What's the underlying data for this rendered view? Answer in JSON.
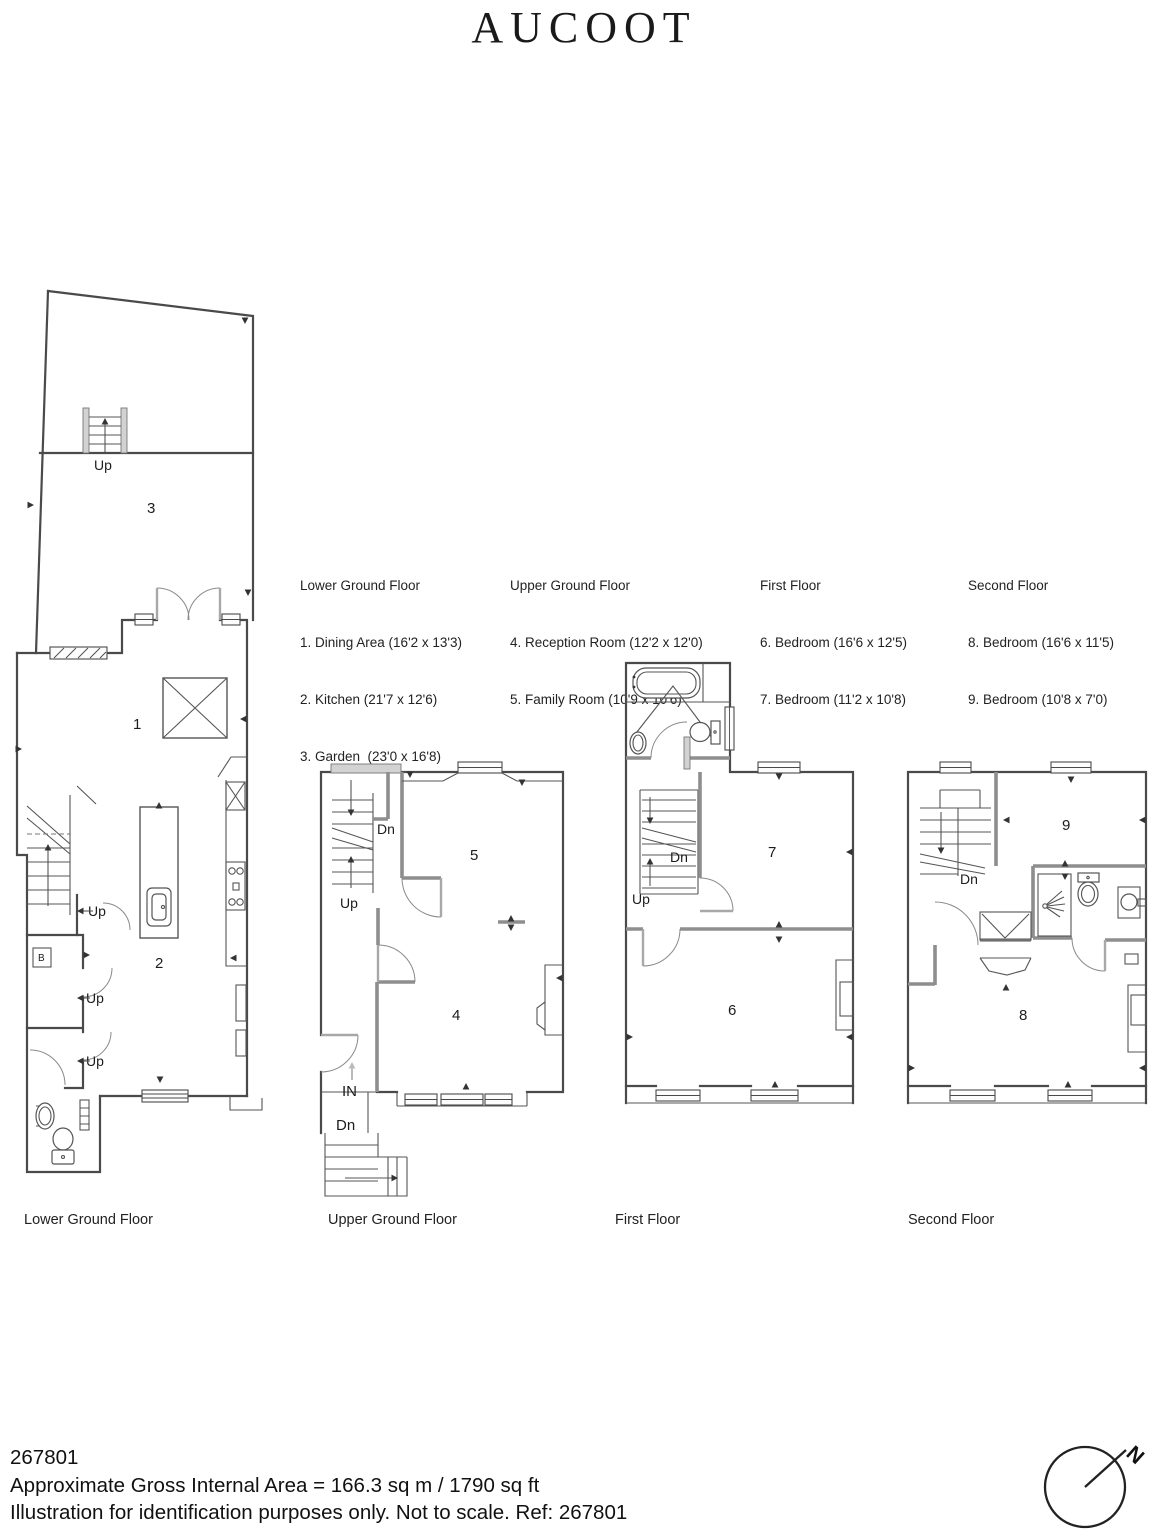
{
  "brand": {
    "logo_text": "AUCOOT"
  },
  "legend": {
    "columns": [
      {
        "title": "Lower Ground Floor",
        "items": [
          "1. Dining Area (16'2 x 13'3)",
          "2. Kitchen (21'7 x 12'6)",
          "3. Garden  (23'0 x 16'8)"
        ]
      },
      {
        "title": "Upper Ground Floor",
        "items": [
          "4. Reception Room (12'2 x 12'0)",
          "5. Family Room (10'9 x 10'6)"
        ]
      },
      {
        "title": "First Floor",
        "items": [
          "6. Bedroom (16'6 x 12'5)",
          "7. Bedroom (11'2 x 10'8)"
        ]
      },
      {
        "title": "Second Floor",
        "items": [
          "8. Bedroom (16'6 x 11'5)",
          "9. Bedroom (10'8 x 7'0)"
        ]
      }
    ]
  },
  "plans": {
    "lower_ground": {
      "caption": "Lower Ground Floor",
      "rooms": {
        "dining": "1",
        "kitchen": "2",
        "garden": "3"
      },
      "labels": {
        "garden_up": "Up",
        "stair_up": "Up",
        "door_up_1": "Up",
        "door_up_2": "Up",
        "boiler": "B"
      }
    },
    "upper_ground": {
      "caption": "Upper Ground Floor",
      "rooms": {
        "reception": "4",
        "family": "5"
      },
      "labels": {
        "dn": "Dn",
        "up": "Up",
        "entrance": "IN",
        "external_dn": "Dn"
      }
    },
    "first": {
      "caption": "First Floor",
      "rooms": {
        "bedroom6": "6",
        "bedroom7": "7"
      },
      "labels": {
        "dn": "Dn",
        "up": "Up"
      }
    },
    "second": {
      "caption": "Second Floor",
      "rooms": {
        "bedroom8": "8",
        "bedroom9": "9"
      },
      "labels": {
        "dn": "Dn"
      }
    }
  },
  "footer": {
    "ref_number": "267801",
    "area_line": "Approximate Gross Internal Area = 166.3 sq m / 1790 sq ft",
    "disclaimer_line": "Illustration for identification purposes only. Not to scale. Ref: 267801"
  },
  "compass": {
    "north_label": "N"
  }
}
